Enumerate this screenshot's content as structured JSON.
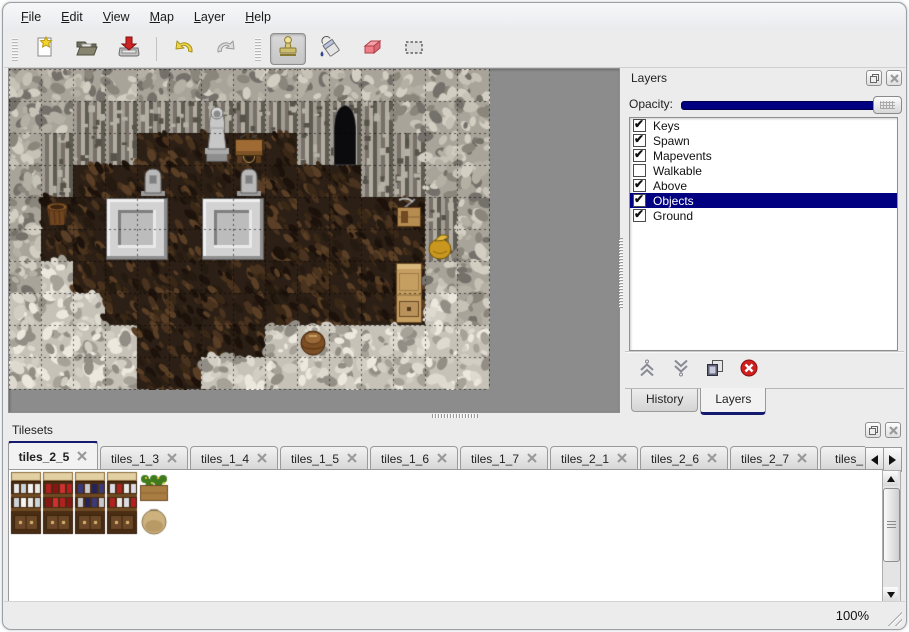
{
  "window": {
    "background": "#ececec",
    "accent_navy": "#000080"
  },
  "menu": {
    "items": [
      {
        "label": "File"
      },
      {
        "label": "Edit"
      },
      {
        "label": "View"
      },
      {
        "label": "Map"
      },
      {
        "label": "Layer"
      },
      {
        "label": "Help"
      }
    ]
  },
  "toolbar": {
    "file_tools": [
      {
        "name": "new-file"
      },
      {
        "name": "open-file"
      },
      {
        "name": "save-file"
      }
    ],
    "history_tools": [
      {
        "name": "undo"
      },
      {
        "name": "redo"
      }
    ],
    "edit_tools": [
      {
        "name": "stamp-tool",
        "active": true
      },
      {
        "name": "fill-tool",
        "active": false
      },
      {
        "name": "eraser-tool",
        "active": false
      },
      {
        "name": "rect-select-tool",
        "active": false
      }
    ]
  },
  "map_view": {
    "tile_size": 32,
    "columns": 15,
    "rows": 10,
    "legend": {
      "W": "rock-wall",
      "F": "wall-face",
      "B": "wood-floor",
      "R": "rubble-floor"
    },
    "terrain": [
      "WWWWWWWWWWWWWWW",
      "WWFFFFFFFFFFWWW",
      "WFFFBBBBBFFFFWW",
      "WFBBBBBBBBBFFWW",
      "WBBBBBBBBBBBBFW",
      "WBBBBBBBBBBBBFW",
      "WRBBBBBBBBBBBWW",
      "RRRBBBBBBBBBBRW",
      "RRRRBBBBRRRRRRR",
      "RRRRBBRRRRRRRRR"
    ],
    "objects": [
      {
        "name": "statue",
        "type": "statue",
        "col": 6,
        "row": 1,
        "w": 1,
        "h": 2
      },
      {
        "name": "cave-door",
        "type": "arch",
        "col": 10,
        "row": 1,
        "w": 1,
        "h": 2
      },
      {
        "name": "work-table",
        "type": "table",
        "col": 7,
        "row": 2,
        "w": 1,
        "h": 1
      },
      {
        "name": "tombstone",
        "type": "tombstone",
        "col": 4,
        "row": 3,
        "w": 1,
        "h": 1
      },
      {
        "name": "tombstone",
        "type": "tombstone",
        "col": 7,
        "row": 3,
        "w": 1,
        "h": 1
      },
      {
        "name": "stone-platform",
        "type": "platform",
        "col": 3,
        "row": 4,
        "w": 2,
        "h": 2
      },
      {
        "name": "stone-platform",
        "type": "platform",
        "col": 6,
        "row": 4,
        "w": 2,
        "h": 2
      },
      {
        "name": "brazier",
        "type": "brazier",
        "col": 1,
        "row": 4,
        "w": 1,
        "h": 1
      },
      {
        "name": "tool-crate",
        "type": "crateTools",
        "col": 12,
        "row": 4,
        "w": 1,
        "h": 1
      },
      {
        "name": "gold-bag",
        "type": "goldBag",
        "col": 13,
        "row": 5,
        "w": 1,
        "h": 1
      },
      {
        "name": "cabinet",
        "type": "cabinet",
        "col": 12,
        "row": 6,
        "w": 1,
        "h": 2
      },
      {
        "name": "barrel",
        "type": "barrel",
        "col": 9,
        "row": 8,
        "w": 1,
        "h": 1
      }
    ]
  },
  "layers_panel": {
    "title": "Layers",
    "opacity_label": "Opacity:",
    "opacity_value": 100,
    "layers": [
      {
        "label": "Keys",
        "checked": true,
        "selected": false
      },
      {
        "label": "Spawn",
        "checked": true,
        "selected": false
      },
      {
        "label": "Mapevents",
        "checked": true,
        "selected": false
      },
      {
        "label": "Walkable",
        "checked": false,
        "selected": false
      },
      {
        "label": "Above",
        "checked": true,
        "selected": false
      },
      {
        "label": "Objects",
        "checked": true,
        "selected": true
      },
      {
        "label": "Ground",
        "checked": true,
        "selected": false
      }
    ],
    "actions": [
      {
        "name": "move-layer-up"
      },
      {
        "name": "move-layer-down"
      },
      {
        "name": "duplicate-layer"
      },
      {
        "name": "delete-layer"
      }
    ],
    "tabs": [
      {
        "label": "History",
        "active": false
      },
      {
        "label": "Layers",
        "active": true
      }
    ]
  },
  "tilesets_panel": {
    "title": "Tilesets",
    "tabs": [
      {
        "label": "tiles_2_5",
        "active": true,
        "clipped": false
      },
      {
        "label": "tiles_1_3",
        "active": false,
        "clipped": false
      },
      {
        "label": "tiles_1_4",
        "active": false,
        "clipped": false
      },
      {
        "label": "tiles_1_5",
        "active": false,
        "clipped": false
      },
      {
        "label": "tiles_1_6",
        "active": false,
        "clipped": false
      },
      {
        "label": "tiles_1_7",
        "active": false,
        "clipped": false
      },
      {
        "label": "tiles_2_1",
        "active": false,
        "clipped": false
      },
      {
        "label": "tiles_2_6",
        "active": false,
        "clipped": false
      },
      {
        "label": "tiles_2_7",
        "active": false,
        "clipped": false
      },
      {
        "label": "tiles_",
        "active": false,
        "clipped": true
      }
    ],
    "tiles": [
      {
        "name": "shelf-dishes",
        "type": "shelf",
        "col": 0,
        "row": 0,
        "items": [
          "#e8e8e8",
          "#ccd4dc",
          "#f4f4f4"
        ]
      },
      {
        "name": "shelf-red-bottles",
        "type": "shelf",
        "col": 1,
        "row": 0,
        "items": [
          "#b42020",
          "#8a1414",
          "#d03030"
        ]
      },
      {
        "name": "shelf-pots",
        "type": "shelf",
        "col": 2,
        "row": 0,
        "items": [
          "#3a3a7a",
          "#c8c8d0",
          "#23235a"
        ]
      },
      {
        "name": "shelf-jars",
        "type": "shelf",
        "col": 3,
        "row": 0,
        "items": [
          "#dcdce4",
          "#b42020",
          "#e8e8e8"
        ]
      },
      {
        "name": "plant-box",
        "type": "plantbox",
        "col": 4,
        "row": 0
      },
      {
        "name": "sack",
        "type": "sack",
        "col": 4,
        "row": 1
      },
      {
        "name": "crate-goods",
        "type": "cratefish",
        "col": 5,
        "row": 0
      },
      {
        "name": "open-sack-gold",
        "type": "sackopen",
        "col": 5,
        "row": 1
      },
      {
        "name": "sack-pile",
        "type": "sackpile",
        "col": 6,
        "row": 0
      },
      {
        "name": "crate-crossed",
        "type": "cratex",
        "col": 7,
        "row": 0
      },
      {
        "name": "crate-crossed",
        "type": "cratex",
        "col": 7,
        "row": 1
      },
      {
        "name": "crate-slats",
        "type": "crateslats",
        "col": 8,
        "row": 0
      },
      {
        "name": "crate-navy",
        "type": "cratenavy",
        "col": 8,
        "row": 1
      },
      {
        "name": "crate-slats",
        "type": "crateslats",
        "col": 9,
        "row": 0
      },
      {
        "name": "crate-navy",
        "type": "cratenavy",
        "col": 9,
        "row": 1
      },
      {
        "name": "crate-metal",
        "type": "cratemetal",
        "col": 10,
        "row": 0
      },
      {
        "name": "ladder-orange",
        "type": "ladder",
        "col": 11,
        "row": 0,
        "rail": "#7a3a10",
        "rung": "#d98a2e"
      },
      {
        "name": "ladder-brown",
        "type": "ladder",
        "col": 12,
        "row": 0,
        "rail": "#4e2e12",
        "rung": "#9a6a38"
      },
      {
        "name": "ladder-steel",
        "type": "ladder",
        "col": 13,
        "row": 0,
        "rail": "#2e2e34",
        "rung": "#9aa0ac"
      },
      {
        "name": "stone-arch",
        "type": "archstone",
        "col": 14,
        "row": 0
      },
      {
        "name": "stone-door",
        "type": "doorstone",
        "col": 14,
        "row": 1
      },
      {
        "name": "stone-door",
        "type": "doorstone",
        "col": 15,
        "row": 1
      },
      {
        "name": "bookshelf",
        "type": "bookshelf",
        "col": 0,
        "row": 2,
        "items": [
          "#d8a0b0",
          "#e0e0e8",
          "#c8c8c8"
        ]
      },
      {
        "name": "bookshelf",
        "type": "bookshelf",
        "col": 1,
        "row": 2,
        "items": [
          "#2a8a2a",
          "#c82020",
          "#d8b020",
          "#2050b0"
        ]
      },
      {
        "name": "bookshelf",
        "type": "bookshelf",
        "col": 2,
        "row": 2,
        "items": [
          "#c82020",
          "#2050b0",
          "#e0e0e0",
          "#c87820"
        ]
      },
      {
        "name": "bookshelf",
        "type": "bookshelf",
        "col": 3,
        "row": 2,
        "items": [
          "#2050b0",
          "#20a050",
          "#c82020",
          "#e8d040"
        ]
      },
      {
        "name": "crate-tan",
        "type": "cratetan",
        "col": 4,
        "row": 2
      },
      {
        "name": "crate-tan-tall",
        "type": "cratetanlid",
        "col": 5,
        "row": 2
      },
      {
        "name": "crate-tan",
        "type": "cratetan",
        "col": 6,
        "row": 2
      },
      {
        "name": "crate-tan",
        "type": "cratetan",
        "col": 4,
        "row": 3
      },
      {
        "name": "crate-tan",
        "type": "cratetan",
        "col": 5,
        "row": 3
      },
      {
        "name": "crate-tan",
        "type": "cratetan",
        "col": 6,
        "row": 3
      },
      {
        "name": "crate-tan",
        "type": "cratetan",
        "col": 7,
        "row": 3
      },
      {
        "name": "barrel-pile",
        "type": "barrelpile",
        "col": 8,
        "row": 2
      },
      {
        "name": "barrels-upright",
        "type": "barrelsup",
        "col": 10,
        "row": 2
      },
      {
        "name": "pot-stack",
        "type": "potstack",
        "col": 11,
        "row": 2
      },
      {
        "name": "bed-green",
        "type": "bed",
        "col": 12,
        "row": 2,
        "blanket": "#7ab060"
      },
      {
        "name": "bed-blue",
        "type": "bed",
        "col": 13,
        "row": 2,
        "blanket": "#3a8ad0"
      },
      {
        "name": "bed-white",
        "type": "bed",
        "col": 14,
        "row": 2,
        "blanket": ""
      },
      {
        "name": "bed-purple",
        "type": "bed",
        "col": 15,
        "row": 2,
        "blanket": "#b06ac0"
      }
    ]
  },
  "status_bar": {
    "zoom": "100%"
  }
}
